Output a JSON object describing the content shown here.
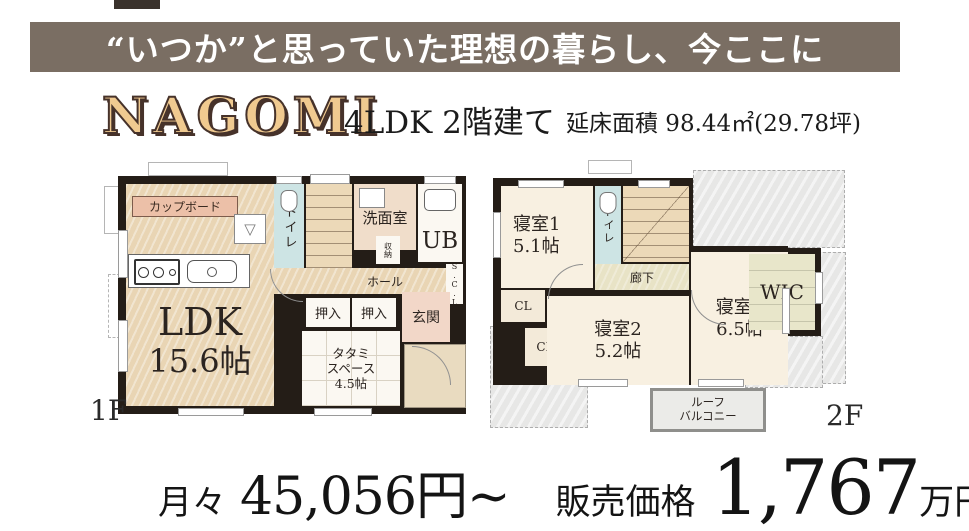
{
  "banner": {
    "text": "“いつか”と思っていた理想の暮らし、今ここに",
    "bg_color": "#7a6e63"
  },
  "header": {
    "logo": "NAGOMI",
    "building_type": "4LDK 2階建て",
    "floor_area": "延床面積 98.44㎡(29.78坪)"
  },
  "floor1": {
    "label": "1F",
    "ldk": {
      "name": "LDK",
      "size": "15.6帖"
    },
    "cupboard": "カップボード",
    "range_symbol": "▽",
    "toilet": "トイレ",
    "washroom": "洗面室",
    "bath": "UB",
    "storage": "収納",
    "hall": "ホール",
    "scl": "S.C.L",
    "closet1": "押入",
    "closet2": "押入",
    "entrance": "玄関",
    "tatami": {
      "line1": "タタミ",
      "line2": "スペース",
      "line3": "4.5帖"
    }
  },
  "floor2": {
    "label": "2F",
    "bedroom1": {
      "name": "寝室1",
      "size": "5.1帖"
    },
    "toilet": "トイレ",
    "corridor": "廊下",
    "closet1": "CL",
    "closet2": "CL",
    "bedroom2": {
      "name": "寝室2",
      "size": "5.2帖"
    },
    "bedroom3": {
      "name": "寝室3",
      "size": "6.5帖"
    },
    "wic": "WIC",
    "balcony": {
      "line1": "ルーフ",
      "line2": "バルコニー"
    }
  },
  "pricing": {
    "monthly_label": "月々",
    "monthly_value": "45,056円~",
    "price_label": "販売価格",
    "price_value": "1,767",
    "price_unit": "万円"
  },
  "colors": {
    "banner_bg": "#7a6e63",
    "logo_fill": "#f0ca90",
    "logo_outline": "#46322a",
    "wall": "#241d17",
    "wood_floor": "#e9d5b4",
    "toilet_blue": "#cde4e4",
    "washroom_beige": "#f0ddca",
    "entrance_pink": "#f2d7c8",
    "cupboard_pink": "#ecc0a8",
    "bedroom_cream": "#f8f0e1",
    "wic_green": "#e8e6ca",
    "roof_gray": "#e7e7e6"
  }
}
